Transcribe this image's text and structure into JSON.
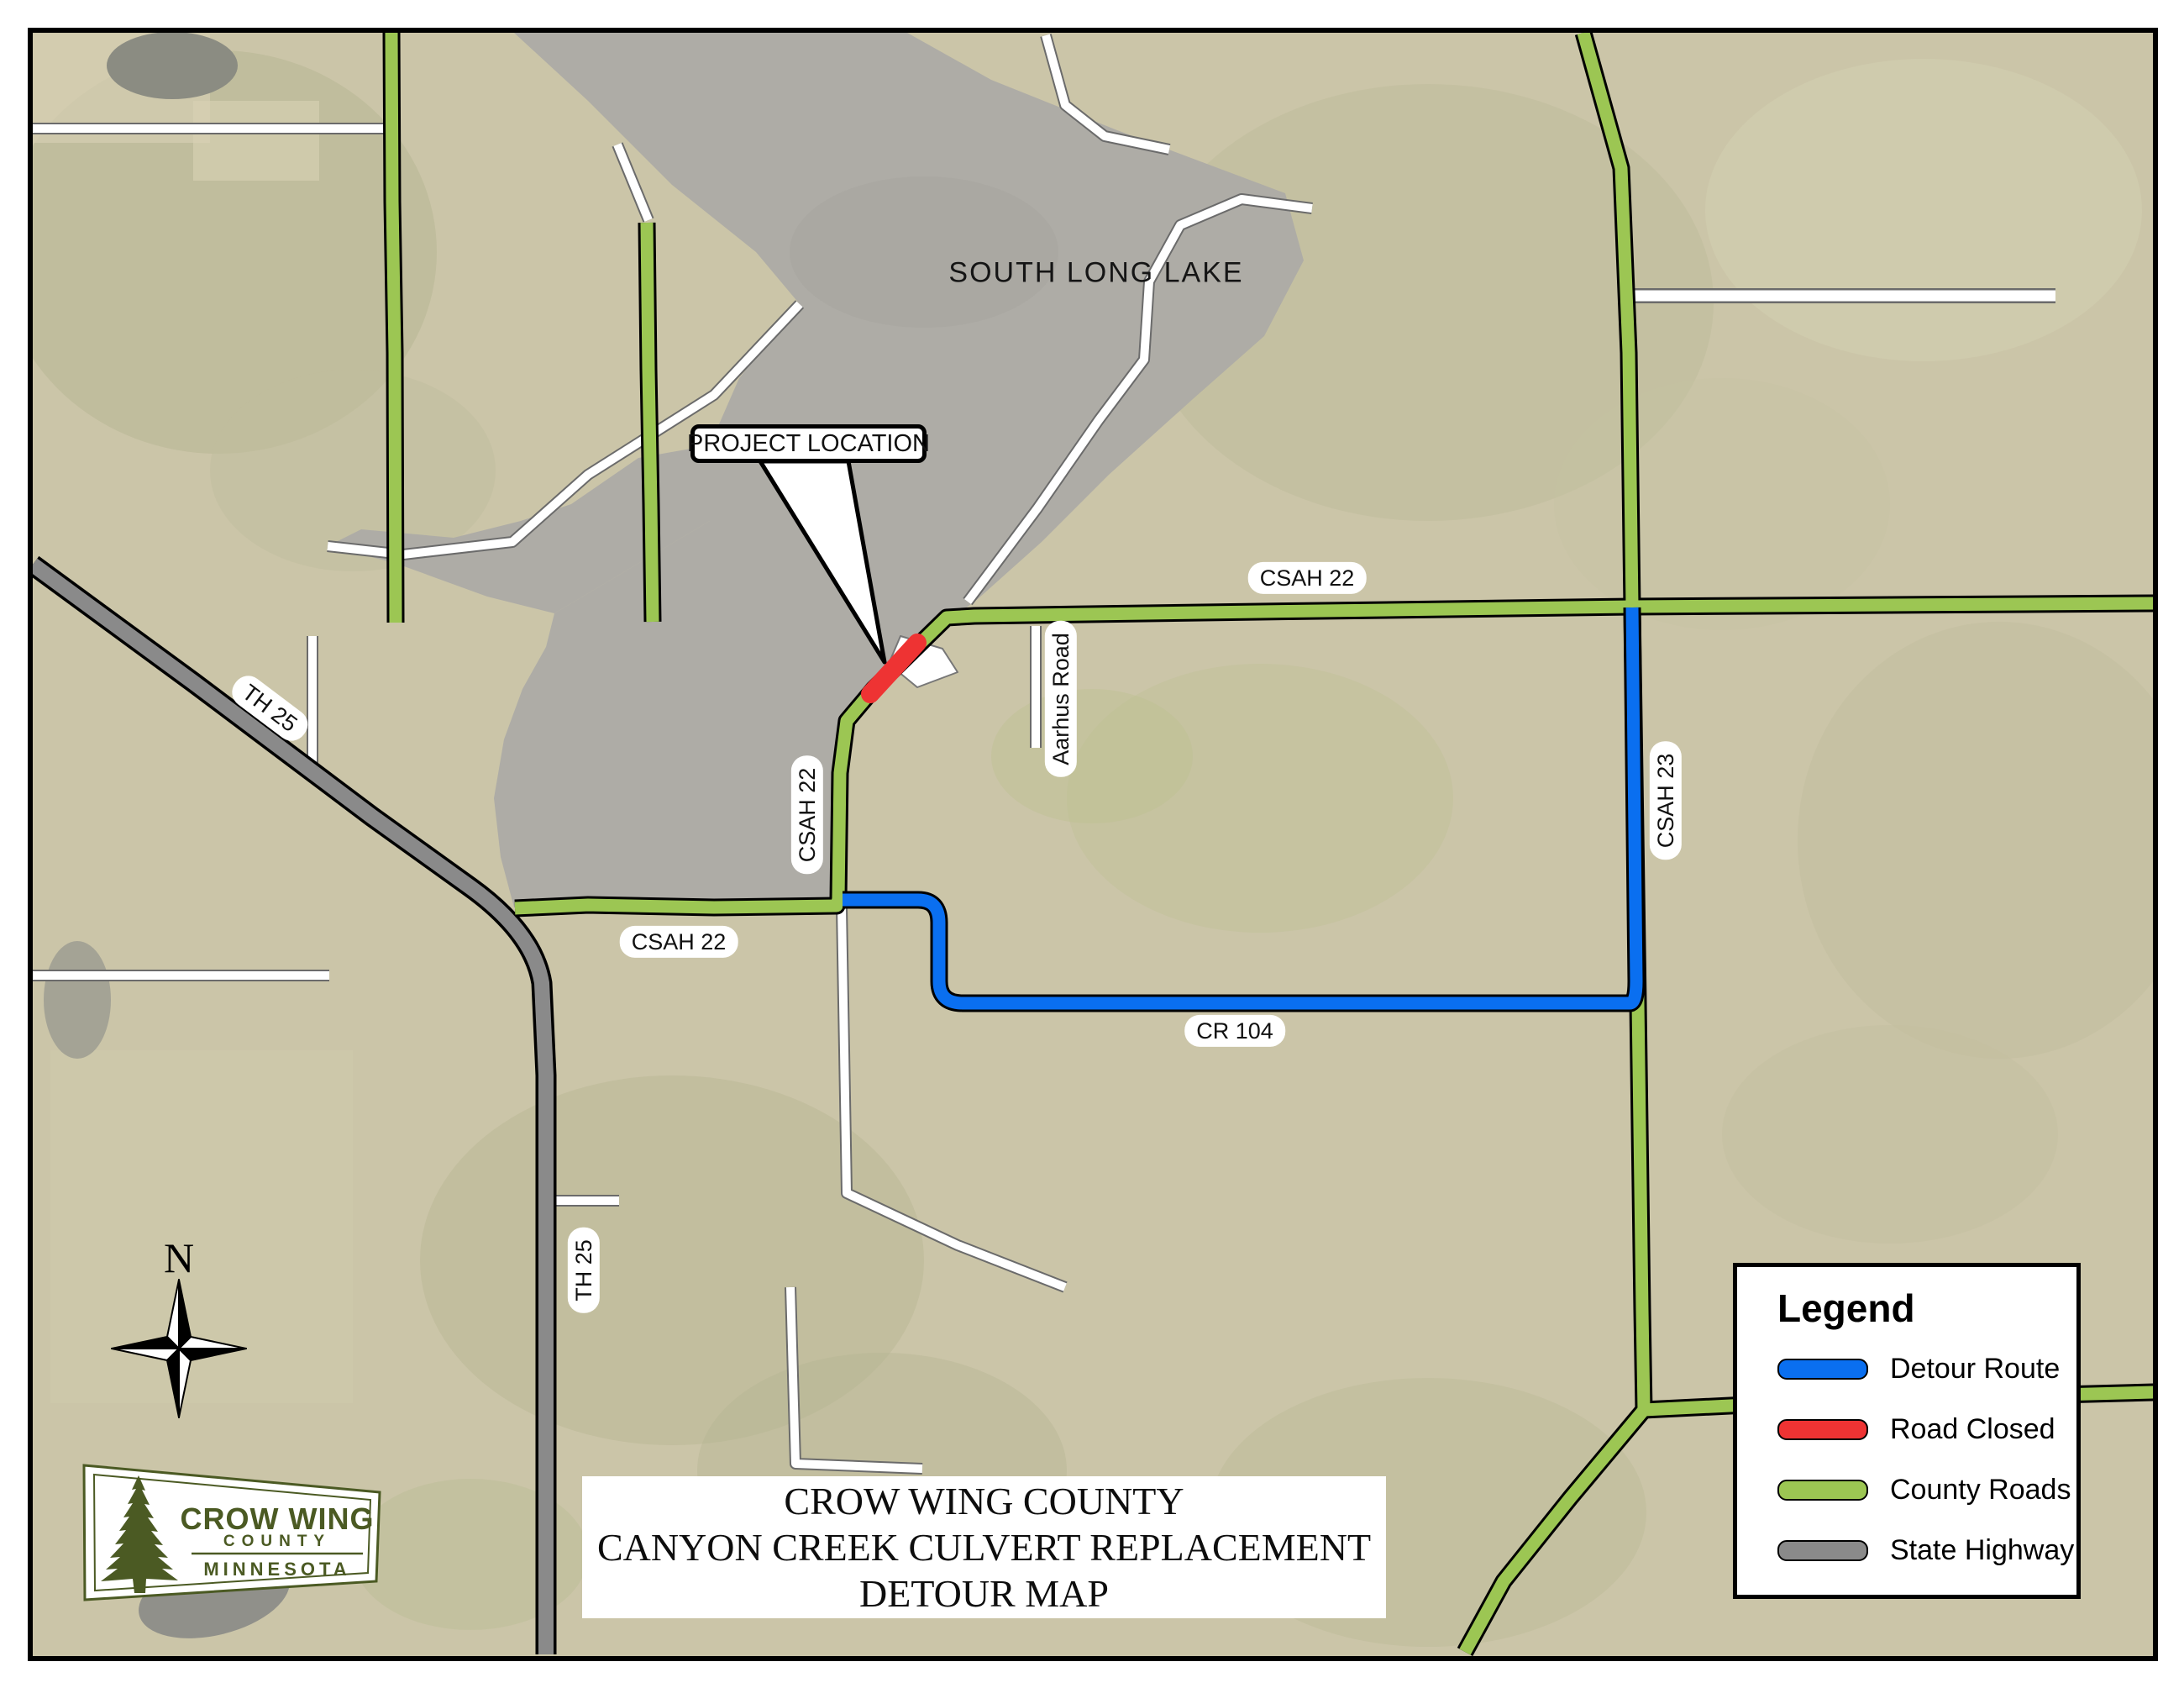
{
  "map": {
    "lake_label": "SOUTH LONG LAKE",
    "callout_label": "PROJECT LOCATION",
    "north_label": "N",
    "road_labels": {
      "csah22_top": "CSAH 22",
      "csah22_vertical": "CSAH 22",
      "csah22_west": "CSAH 22",
      "csah23": "CSAH 23",
      "cr104": "CR 104",
      "th25_diagonal": "TH 25",
      "th25_vertical": "TH 25",
      "aarhus_road": "Aarhus Road"
    },
    "colors": {
      "lake": "#aeaca6",
      "terrain": "#cbc5a8",
      "road_casing": "#000000"
    }
  },
  "legend": {
    "title": "Legend",
    "items": [
      {
        "label": "Detour Route",
        "color": "#0a6ff0"
      },
      {
        "label": "Road Closed",
        "color": "#ee3333"
      },
      {
        "label": "County Roads",
        "color": "#9cc653"
      },
      {
        "label": "State Highway",
        "color": "#8a8a8a"
      }
    ]
  },
  "title_block": {
    "line1": "CROW WING COUNTY",
    "line2": "CANYON CREEK CULVERT REPLACEMENT",
    "line3": "DETOUR MAP"
  },
  "logo": {
    "name": "CROW WING",
    "county": "COUNTY",
    "state": "MINNESOTA",
    "color": "#4b5a23"
  }
}
